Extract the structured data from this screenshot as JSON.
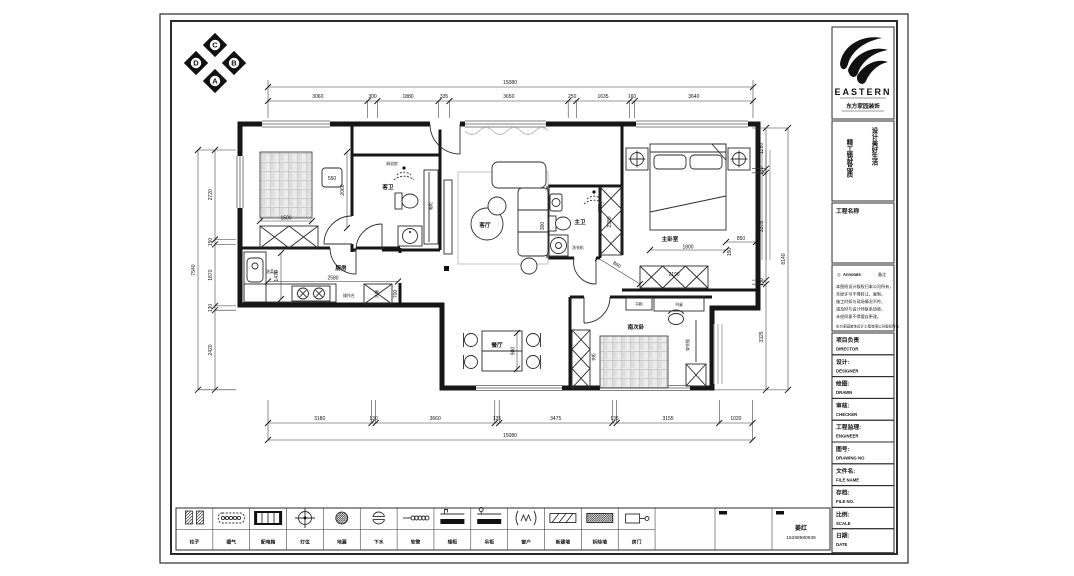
{
  "colors": {
    "ink": "#161616",
    "gray": "#9a9a9a",
    "paper": "#ffffff"
  },
  "compass": {
    "top": "C",
    "bottom": "A",
    "left": "D",
    "right": "B"
  },
  "dims": {
    "top_total": "15080",
    "top": [
      "3060",
      "300",
      "1880",
      "335",
      "3650",
      "250",
      "1635",
      "160",
      "3640"
    ],
    "bottom": [
      "3180",
      "130",
      "3660",
      "135",
      "3475",
      "135",
      "3155",
      "1020"
    ],
    "bottom_total": "15080",
    "left_total": "7540",
    "left": [
      "2720",
      "150",
      "1870",
      "130",
      "2420"
    ],
    "right": [
      "1280",
      "130",
      "3375",
      "130",
      "3325"
    ],
    "right_total": "8140",
    "inner": {
      "bed1_w": "1500",
      "nightstand": "550",
      "bed1_h": "2060",
      "kitchen_w": "2580",
      "kitchen_h": "1470",
      "fridge_w": "700",
      "dining_h": "900",
      "shower": "620",
      "basin": "300",
      "closet_h": "2380",
      "bed2_w": "1800",
      "bed2_gap": "150",
      "bed2_side": "850",
      "wardrobe_w": "2190",
      "hall_diag": "860"
    }
  },
  "rooms": {
    "living": "客厅",
    "dining": "餐厅",
    "kitchen": "厨房",
    "master_bath": "主卫",
    "guest_bath": "客卫",
    "master_bedroom": "主卧室",
    "south_bedroom": "南次卧"
  },
  "labels": {
    "washer": "洗衣机",
    "shower_room": "淋浴房",
    "basin_counter": "洗手台",
    "shoe_cabinet": "鞋柜",
    "counter": "操作台",
    "fridge": "冰箱",
    "sink": "洗菜盆",
    "desk": "书桌",
    "bookcase": "书柜",
    "wardrobe": "衣柜",
    "mirror": "穿衣镜"
  },
  "title_block": {
    "brand": "EASTERN",
    "company": "东方家园装饰",
    "slogan_right": "设计美好生活",
    "slogan_left": "精工铸就品质",
    "project_label": "工程名称",
    "notes": {
      "icon": "◎",
      "header_left": "Annotate",
      "header_right": "备注",
      "lines": [
        "本图纸设计版权归本公司所有，",
        "未经许可不得转让、复制，",
        "施工时如与现场情况不符，",
        "请及时与设计师联系协商，",
        "未经同意不得擅自更改。"
      ],
      "footer": "东方家园装饰设计工程有限公司版权所有"
    },
    "rows": [
      {
        "cn": "项目负责",
        "en": "DIRECTOR"
      },
      {
        "cn": "设计:",
        "en": "DESIGNER"
      },
      {
        "cn": "绘图:",
        "en": "DRAWN"
      },
      {
        "cn": "审核:",
        "en": "CHECKER"
      },
      {
        "cn": "工程监理:",
        "en": "ENGINEER"
      },
      {
        "cn": "图号:",
        "en": "DRAWING NO"
      },
      {
        "cn": "文件名:",
        "en": "FILE NAME"
      },
      {
        "cn": "存档:",
        "en": "FILE NO."
      },
      {
        "cn": "比例:",
        "en": "SCALE"
      },
      {
        "cn": "日期:",
        "en": "DATE"
      }
    ]
  },
  "legend": {
    "labels": [
      "柱子",
      "暖气",
      "配电箱",
      "灯位",
      "地漏",
      "下水",
      "软管",
      "矮柜",
      "吊柜",
      "窗户",
      "新建墙",
      "拆除墙",
      "房门"
    ],
    "contact_name": "姜红",
    "contact_phone": "15288980639"
  }
}
